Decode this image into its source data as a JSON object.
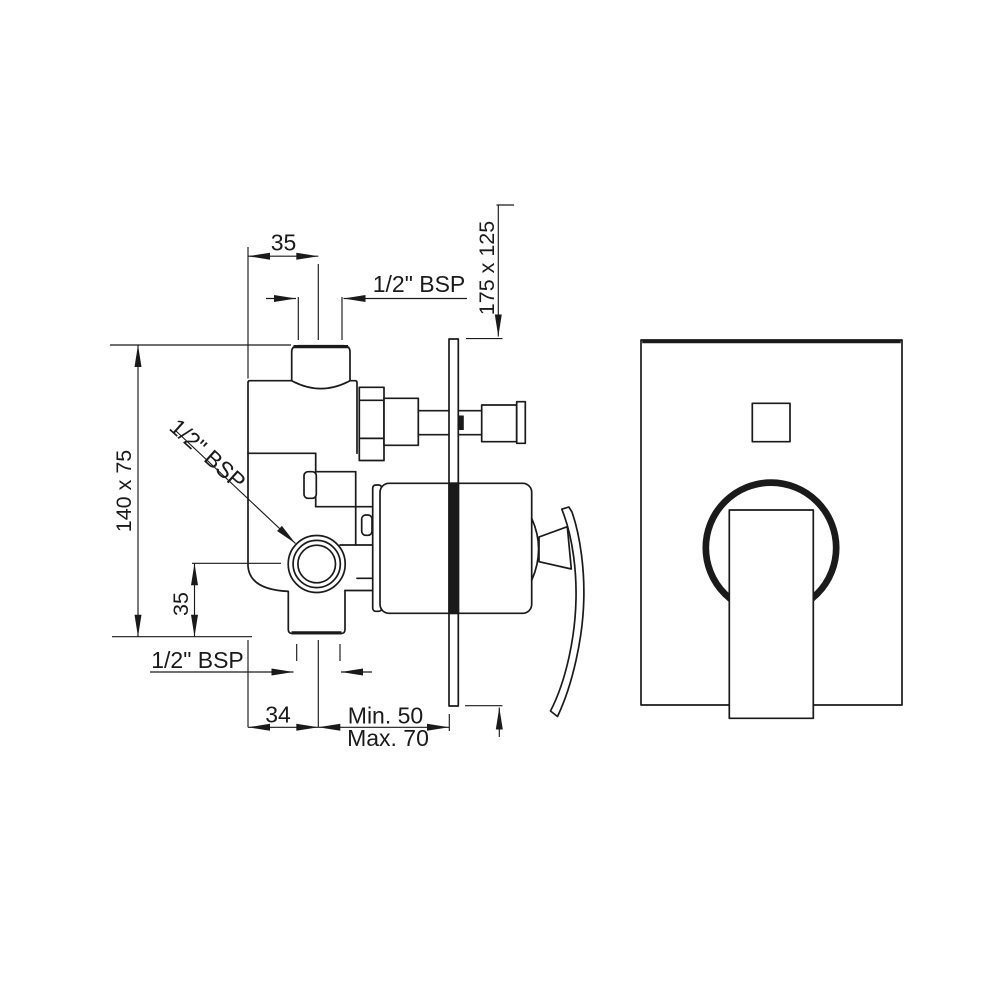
{
  "drawing": {
    "kind": "installation dimension diagram",
    "subject": "concealed single-lever shower mixer (side section + front faceplate view)",
    "colors": {
      "line": "#1a1a1a",
      "background": "#ffffff"
    }
  },
  "labels": {
    "top_width": "35",
    "top_thread": "1/2\" BSP",
    "plate_size": "175 x 125",
    "body_size": "140 x 75",
    "side_thread": "1/2\" BSP",
    "side_offset": "35",
    "bottom_thread": "1/2\" BSP",
    "bottom_offset": "34",
    "depth_min": "Min. 50",
    "depth_max": "Max. 70"
  }
}
